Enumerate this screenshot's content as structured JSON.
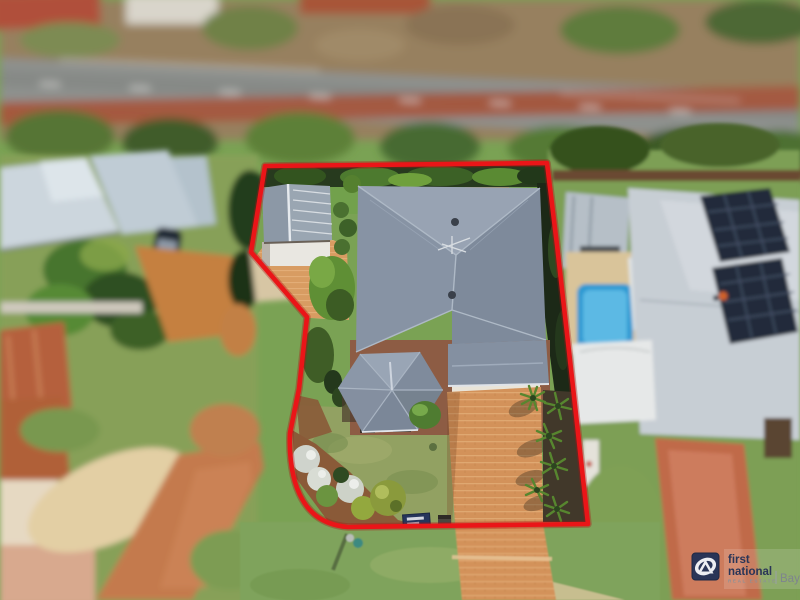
{
  "image": {
    "kind": "aerial-drone-photo",
    "subject": "residential property for sale outlined in red",
    "effect": "tilt-shift (sharp centre, blurred surroundings)"
  },
  "watermark": {
    "line1": "first",
    "line2": "national",
    "tagline": "REAL ESTATE",
    "suffix": "Bay",
    "navy": "#2a3557",
    "gray": "#8d9096"
  },
  "boundary": {
    "name": "property-boundary-outline",
    "color": "#ea1518"
  },
  "scene": {
    "road_top": "tree-lined main road with white lane markings and red median strip",
    "target_property": {
      "main_house_roof_color": "#8793a4",
      "shed": "white shed with grey gable roof at rear left",
      "driveway": "orange brick paved driveway on right side",
      "front_garden": "white flowering shrubs and round bushes at front left",
      "palms": "row of palms along right edge of driveway",
      "hedge": "dark hedge along rear and right boundaries",
      "for_sale_sign": "navy agency sign at front boundary"
    },
    "left_neighbour": "pale-roofed house, dark parked car, palms, terracotta roofs, paved street",
    "right_neighbour": "grey roof with solar panels, blue swimming pool, white shed, red driveway"
  },
  "colors": {
    "lawn": "#7aa254",
    "front_lawn": "#92a162",
    "driveway_brick": "#d3925a",
    "road_asphalt": "#8e918e",
    "red_median": "#a6543a",
    "pool_blue": "#2f9ad2",
    "solar_panel": "#232c3a",
    "terracotta_roof": "#b5613c"
  }
}
